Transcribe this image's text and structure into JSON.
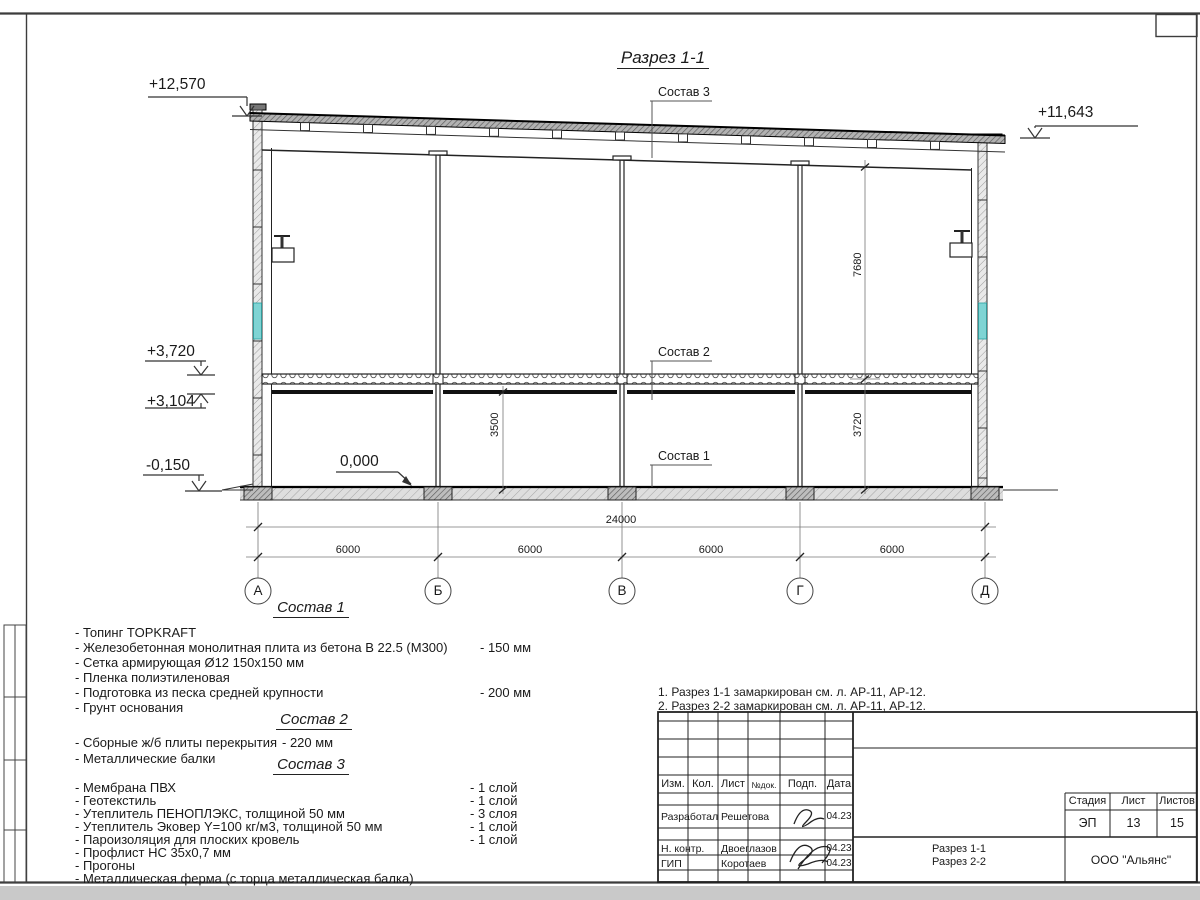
{
  "drawing": {
    "title": "Разрез 1-1",
    "elevations": {
      "roof_left": "+12,570",
      "roof_right": "+11,643",
      "floor_top": "+3,720",
      "floor_bottom": "+3,104",
      "zero": "0,000",
      "ground": "-0,150"
    },
    "dims": {
      "total": "24000",
      "bay1": "6000",
      "bay2": "6000",
      "bay3": "6000",
      "bay4": "6000",
      "h_upper": "7680",
      "h_lower": "3720",
      "h_clear": "3500"
    },
    "axes": [
      "А",
      "Б",
      "В",
      "Г",
      "Д"
    ],
    "callout1": "Состав 1",
    "callout2": "Состав 2",
    "callout3": "Состав 3"
  },
  "legend": {
    "s1": {
      "title": "Состав 1",
      "items": [
        {
          "n": "- Топинг TOPKRAFT",
          "v": ""
        },
        {
          "n": "- Железобетонная  монолитная плита из бетона  В 22.5 (М300)",
          "v": "- 150 мм"
        },
        {
          "n": "- Сетка армирующая Ø12 150x150 мм",
          "v": ""
        },
        {
          "n": "- Пленка полиэтиленовая",
          "v": ""
        },
        {
          "n": "- Подготовка из песка средней  крупности",
          "v": "- 200 мм"
        },
        {
          "n": "- Грунт основания",
          "v": ""
        }
      ]
    },
    "s2": {
      "title": "Состав 2",
      "items": [
        {
          "n": "- Сборные ж/б плиты перекрытия",
          "v": "- 220 мм"
        },
        {
          "n": "- Металлические балки",
          "v": ""
        }
      ]
    },
    "s3": {
      "title": "Состав 3",
      "items": [
        {
          "n": "- Мембрана ПВХ",
          "v": "- 1 слой"
        },
        {
          "n": "- Геотекстиль",
          "v": "- 1 слой"
        },
        {
          "n": "- Утеплитель ПЕНОПЛЭКС, толщиной 50 мм",
          "v": "- 3 слоя"
        },
        {
          "n": "- Утеплитель Эковер Y=100 кг/м3, толщиной 50 мм",
          "v": "- 1 слой"
        },
        {
          "n": "- Пароизоляция для плоских кровель",
          "v": "- 1 слой"
        },
        {
          "n": "- Профлист НС 35х0,7 мм",
          "v": ""
        },
        {
          "n": "- Прогоны",
          "v": ""
        },
        {
          "n": "- Металлическая ферма (с торца металлическая балка)",
          "v": ""
        }
      ]
    }
  },
  "notes": [
    "1. Разрез 1-1 замаркирован см. л. АР-11, АР-12.",
    "2. Разрез 2-2 замаркирован см. л. АР-11, АР-12."
  ],
  "titleblock": {
    "cols": {
      "izm": "Изм.",
      "kol": "Кол.",
      "list": "Лист",
      "ndok": "№док.",
      "podp": "Подп.",
      "data": "Дата"
    },
    "rows": [
      {
        "role": "Разработал",
        "name": "Решетова",
        "date": "04.23"
      },
      {
        "role": "Н. контр.",
        "name": "Двоеглазов",
        "date": "04.23"
      },
      {
        "role": "ГИП",
        "name": "Коротаев",
        "date": "04.23"
      }
    ],
    "stage_label": "Стадия",
    "sheet_label": "Лист",
    "sheets_label": "Листов",
    "stage": "ЭП",
    "sheet": "13",
    "sheets": "15",
    "doc_title_line1": "Разрез 1-1",
    "doc_title_line2": "Разрез 2-2",
    "company": "ООО \"Альянс\""
  }
}
